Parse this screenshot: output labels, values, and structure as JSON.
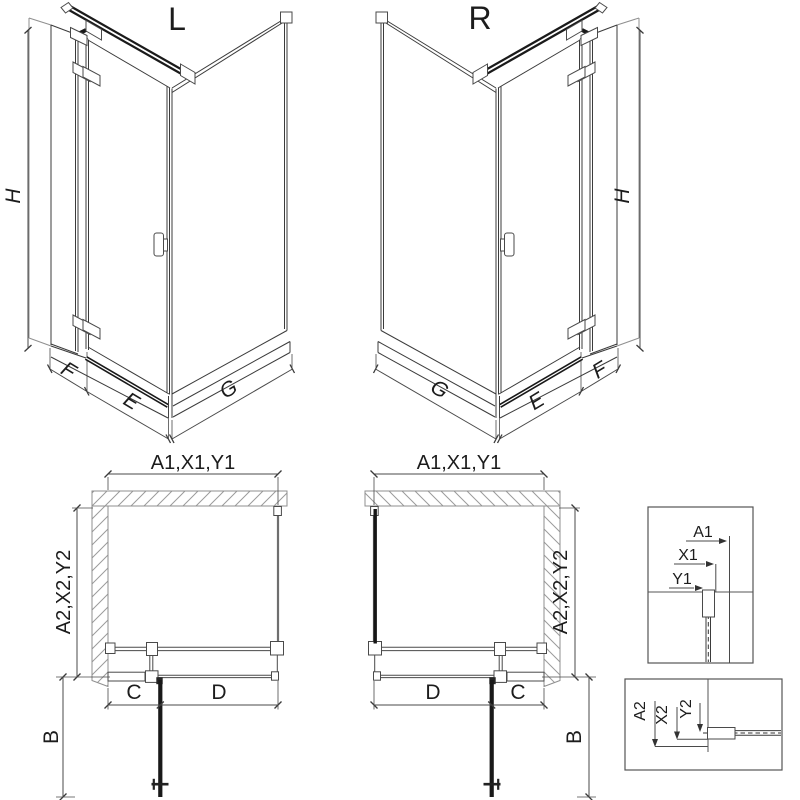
{
  "pictogram_l": {
    "label": "L",
    "dim_height": "H",
    "dim_fixed_width": "F",
    "dim_door_width": "E",
    "dim_side_width": "G"
  },
  "pictogram_r": {
    "label": "R",
    "dim_height": "H",
    "dim_fixed_width": "F",
    "dim_door_width": "E",
    "dim_side_width": "G"
  },
  "plan_l": {
    "dim_width_top": "A1,X1,Y1",
    "dim_depth_side": "A2,X2,Y2",
    "dim_c": "C",
    "dim_d": "D",
    "dim_b": "B"
  },
  "plan_r": {
    "dim_width_top": "A1,X1,Y1",
    "dim_depth_side": "A2,X2,Y2",
    "dim_c": "C",
    "dim_d": "D",
    "dim_b": "B"
  },
  "detail_width": {
    "dim_a1": "A1",
    "dim_x1": "X1",
    "dim_y1": "Y1"
  },
  "detail_depth": {
    "dim_a2": "A2",
    "dim_x2": "X2",
    "dim_y2": "Y2"
  },
  "colors": {
    "line": "#3b3b3b",
    "line_dark": "#1a1a1a",
    "wall": "#8f8f8f",
    "dimension": "#4a4a4a",
    "background": "#ffffff"
  }
}
